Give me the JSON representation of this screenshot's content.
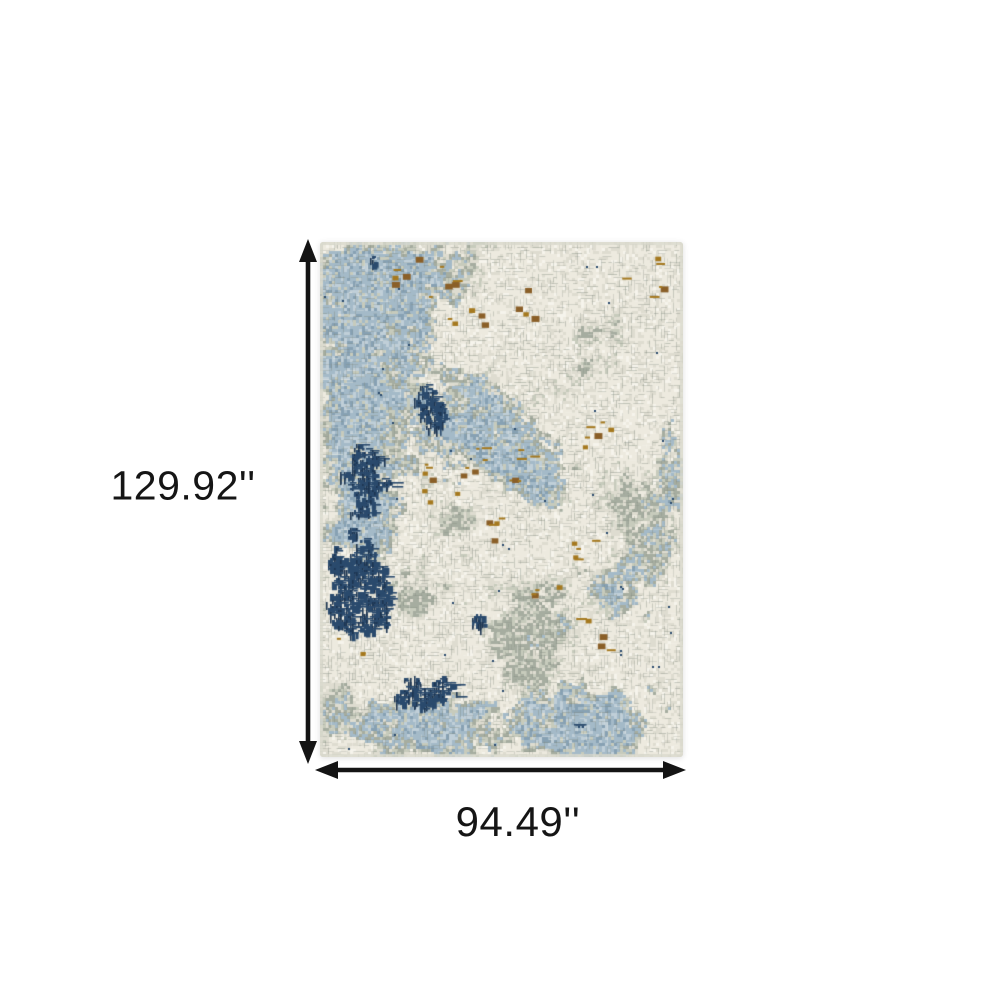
{
  "figure": {
    "type": "product-dimensions",
    "background_color": "#ffffff",
    "arrow_color": "#141414",
    "label_color": "#151515",
    "height_label": "129.92''",
    "width_label": "94.49''",
    "height_value_in": 129.92,
    "width_value_in": 94.49,
    "unit": "inches"
  },
  "rug": {
    "description": "abstract distressed grid-pattern area rug in ivory, grey, steel blue, navy and gold",
    "palette": {
      "cream": "#edeadf",
      "pale": "#dedcd0",
      "gray_light": "#c7cbbc",
      "gray": "#a6ada0",
      "grid": "#80897e",
      "white": "#f6f4ec",
      "blue_light": "#c0cfd8",
      "blue": "#a4bac8",
      "blue_mid": "#87a1b3",
      "navy": "#2a4a6d",
      "navy_dark": "#1d3552",
      "ochre": "#a5791f",
      "rust": "#8a5f28",
      "edge": "#d9dacd"
    },
    "texture": {
      "cell": 3,
      "seed": 11
    },
    "blue_clusters": [
      {
        "x": 0.16,
        "y": 0.08,
        "rx": 0.22,
        "ry": 0.1,
        "s": 0.75
      },
      {
        "x": 0.08,
        "y": 0.28,
        "rx": 0.14,
        "ry": 0.12,
        "s": 0.6
      },
      {
        "x": 0.1,
        "y": 0.52,
        "rx": 0.12,
        "ry": 0.12,
        "s": 0.55
      },
      {
        "x": 0.42,
        "y": 0.34,
        "rx": 0.2,
        "ry": 0.13,
        "s": 0.5
      },
      {
        "x": 0.6,
        "y": 0.45,
        "rx": 0.12,
        "ry": 0.1,
        "s": 0.45
      },
      {
        "x": 0.8,
        "y": 0.68,
        "rx": 0.14,
        "ry": 0.1,
        "s": 0.5
      },
      {
        "x": 0.3,
        "y": 0.95,
        "rx": 0.3,
        "ry": 0.08,
        "s": 0.55
      },
      {
        "x": 0.78,
        "y": 0.93,
        "rx": 0.18,
        "ry": 0.08,
        "s": 0.6
      },
      {
        "x": 0.95,
        "y": 0.4,
        "rx": 0.08,
        "ry": 0.15,
        "s": 0.35
      }
    ],
    "gray_clusters": [
      {
        "x": 0.75,
        "y": 0.2,
        "rx": 0.14,
        "ry": 0.1,
        "s": 0.55
      },
      {
        "x": 0.55,
        "y": 0.3,
        "rx": 0.1,
        "ry": 0.08,
        "s": 0.4
      },
      {
        "x": 0.88,
        "y": 0.55,
        "rx": 0.12,
        "ry": 0.12,
        "s": 0.5
      },
      {
        "x": 0.6,
        "y": 0.75,
        "rx": 0.16,
        "ry": 0.12,
        "s": 0.55
      },
      {
        "x": 0.4,
        "y": 0.55,
        "rx": 0.1,
        "ry": 0.08,
        "s": 0.4
      },
      {
        "x": 0.25,
        "y": 0.68,
        "rx": 0.1,
        "ry": 0.08,
        "s": 0.4
      },
      {
        "x": 0.05,
        "y": 0.9,
        "rx": 0.1,
        "ry": 0.06,
        "s": 0.45
      },
      {
        "x": 0.35,
        "y": 0.05,
        "rx": 0.12,
        "ry": 0.05,
        "s": 0.35
      }
    ],
    "cream_clusters": [
      {
        "x": 0.62,
        "y": 0.18,
        "rx": 0.16,
        "ry": 0.1,
        "s": 0.55
      },
      {
        "x": 0.5,
        "y": 0.6,
        "rx": 0.14,
        "ry": 0.1,
        "s": 0.5
      },
      {
        "x": 0.92,
        "y": 0.08,
        "rx": 0.1,
        "ry": 0.07,
        "s": 0.45
      },
      {
        "x": 0.88,
        "y": 0.28,
        "rx": 0.1,
        "ry": 0.08,
        "s": 0.4
      },
      {
        "x": 0.35,
        "y": 0.75,
        "rx": 0.1,
        "ry": 0.06,
        "s": 0.35
      },
      {
        "x": 0.7,
        "y": 0.05,
        "rx": 0.12,
        "ry": 0.05,
        "s": 0.4
      }
    ],
    "navy_clusters": [
      {
        "x": 0.1,
        "y": 0.68,
        "rx": 0.11,
        "ry": 0.1,
        "s": 1.25
      },
      {
        "x": 0.12,
        "y": 0.45,
        "rx": 0.1,
        "ry": 0.1,
        "s": 0.9
      },
      {
        "x": 0.3,
        "y": 0.32,
        "rx": 0.09,
        "ry": 0.07,
        "s": 0.85
      },
      {
        "x": 0.15,
        "y": 0.04,
        "rx": 0.1,
        "ry": 0.04,
        "s": 0.55
      },
      {
        "x": 0.42,
        "y": 0.17,
        "rx": 0.05,
        "ry": 0.04,
        "s": 0.55
      },
      {
        "x": 0.28,
        "y": 0.87,
        "rx": 0.15,
        "ry": 0.06,
        "s": 0.75
      },
      {
        "x": 0.44,
        "y": 0.74,
        "rx": 0.08,
        "ry": 0.09,
        "s": 0.6
      },
      {
        "x": 0.73,
        "y": 0.04,
        "rx": 0.07,
        "ry": 0.04,
        "s": 0.45
      },
      {
        "x": 0.57,
        "y": 0.52,
        "rx": 0.06,
        "ry": 0.06,
        "s": 0.45
      },
      {
        "x": 0.68,
        "y": 0.93,
        "rx": 0.09,
        "ry": 0.05,
        "s": 0.55
      }
    ],
    "ochre_spots": [
      {
        "x": 0.24,
        "y": 0.05,
        "r": 0.05,
        "n": 5
      },
      {
        "x": 0.33,
        "y": 0.08,
        "r": 0.05,
        "n": 5
      },
      {
        "x": 0.4,
        "y": 0.15,
        "r": 0.05,
        "n": 5
      },
      {
        "x": 0.58,
        "y": 0.12,
        "r": 0.05,
        "n": 4
      },
      {
        "x": 0.88,
        "y": 0.07,
        "r": 0.06,
        "n": 6
      },
      {
        "x": 0.33,
        "y": 0.47,
        "r": 0.06,
        "n": 8
      },
      {
        "x": 0.43,
        "y": 0.42,
        "r": 0.04,
        "n": 5
      },
      {
        "x": 0.55,
        "y": 0.43,
        "r": 0.05,
        "n": 6
      },
      {
        "x": 0.78,
        "y": 0.37,
        "r": 0.06,
        "n": 6
      },
      {
        "x": 0.74,
        "y": 0.6,
        "r": 0.05,
        "n": 5
      },
      {
        "x": 0.75,
        "y": 0.76,
        "r": 0.05,
        "n": 5
      },
      {
        "x": 0.62,
        "y": 0.68,
        "r": 0.04,
        "n": 4
      },
      {
        "x": 0.08,
        "y": 0.77,
        "r": 0.04,
        "n": 3
      },
      {
        "x": 0.47,
        "y": 0.56,
        "r": 0.04,
        "n": 5
      }
    ]
  }
}
